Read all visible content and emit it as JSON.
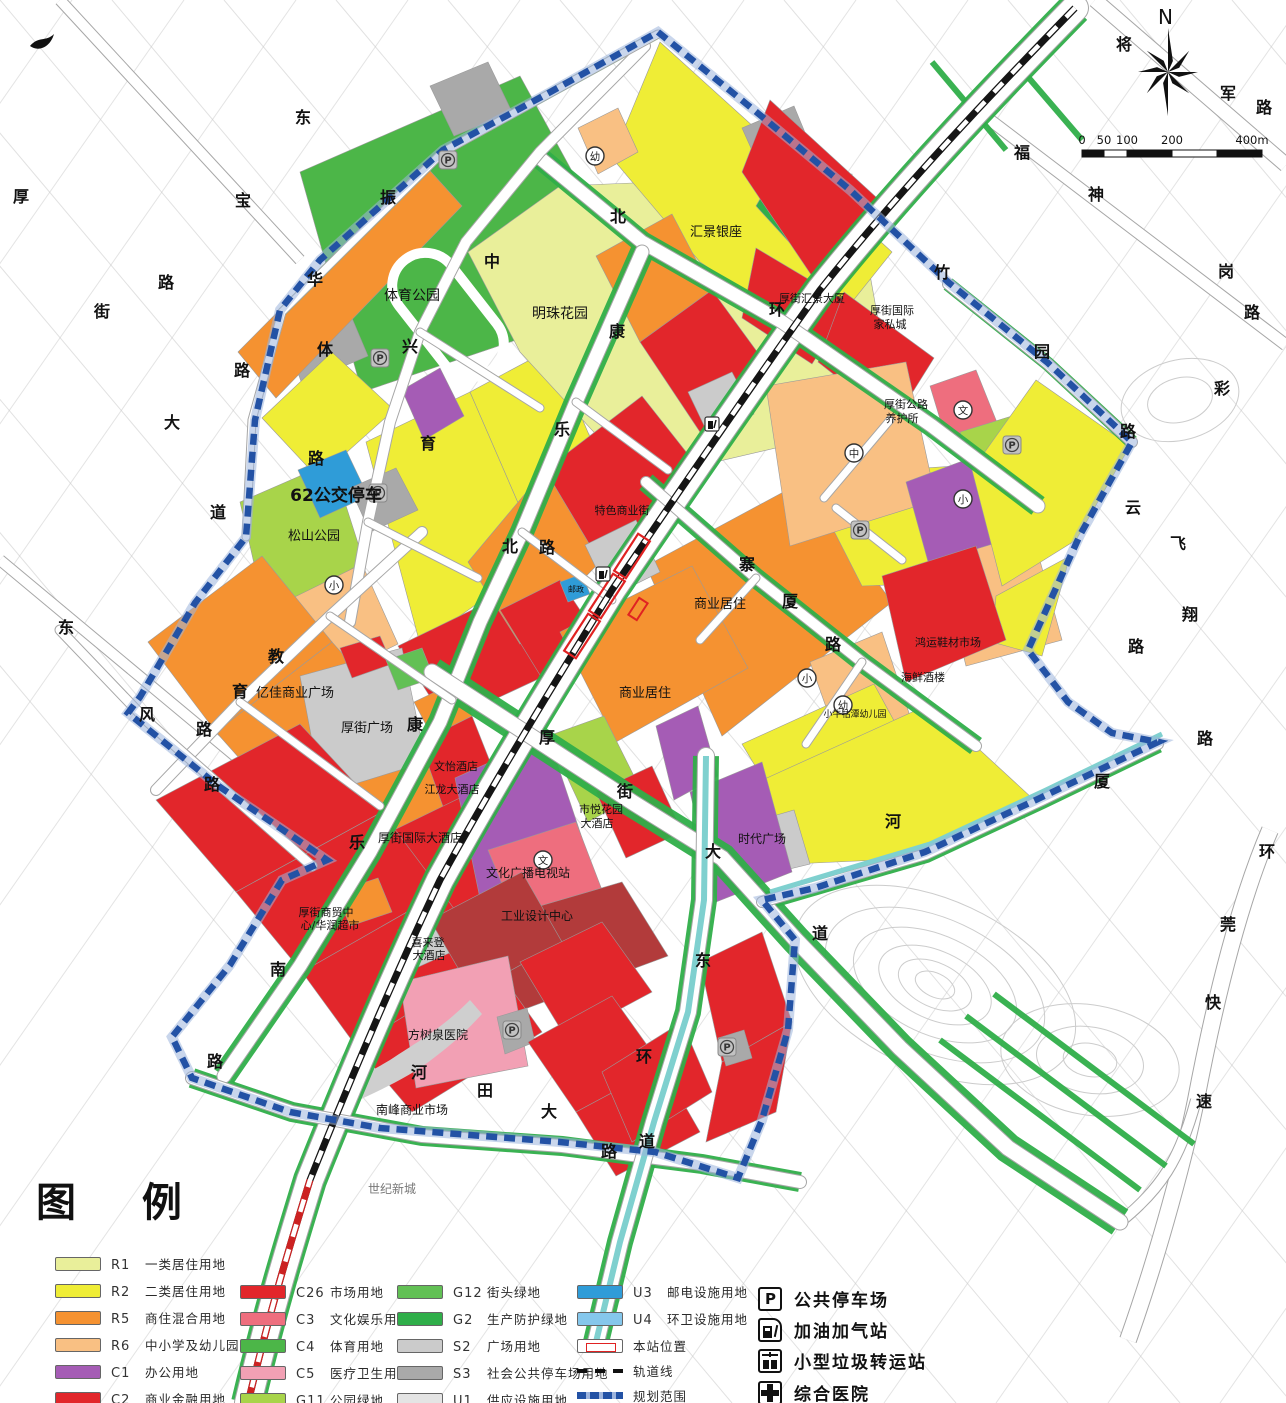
{
  "legend": {
    "title": "图 例",
    "land_use": [
      {
        "code": "R1",
        "label": "一类居住用地",
        "color": "#e9ef9a",
        "col": 1
      },
      {
        "code": "R2",
        "label": "二类居住用地",
        "color": "#efed36",
        "col": 1
      },
      {
        "code": "R5",
        "label": "商住混合用地",
        "color": "#f59231",
        "col": 1
      },
      {
        "code": "R6",
        "label": "中小学及幼儿园用地",
        "color": "#f9c083",
        "col": 1
      },
      {
        "code": "C1",
        "label": "办公用地",
        "color": "#a55cb5",
        "col": 1
      },
      {
        "code": "C2",
        "label": "商业金融用地",
        "color": "#e2262b",
        "col": 1
      },
      {
        "code": "C26",
        "label": "市场用地",
        "color": "#e2262b",
        "col": 2
      },
      {
        "code": "C3",
        "label": "文化娱乐用地",
        "color": "#ee6e7e",
        "col": 2
      },
      {
        "code": "C4",
        "label": "体育用地",
        "color": "#4cb648",
        "col": 2
      },
      {
        "code": "C5",
        "label": "医疗卫生用地",
        "color": "#f2a0b4",
        "col": 2
      },
      {
        "code": "G11",
        "label": "公园绿地",
        "color": "#a8d44a",
        "col": 2
      },
      {
        "code": "G12",
        "label": "街头绿地",
        "color": "#62c055",
        "col": 3
      },
      {
        "code": "G2",
        "label": "生产防护绿地",
        "color": "#2fae49",
        "col": 3
      },
      {
        "code": "S2",
        "label": "广场用地",
        "color": "#cbcbcb",
        "col": 3
      },
      {
        "code": "S3",
        "label": "社会公共停车场用地",
        "color": "#a9a9a9",
        "col": 3
      },
      {
        "code": "U1",
        "label": "供应设施用地",
        "color": "#e4e4e4",
        "col": 3
      },
      {
        "code": "U3",
        "label": "邮电设施用地",
        "color": "#2f9cd8",
        "col": 4
      },
      {
        "code": "U4",
        "label": "环卫设施用地",
        "color": "#85c7ec",
        "col": 4
      }
    ],
    "line_items": [
      {
        "kind": "station",
        "label": "本站位置"
      },
      {
        "kind": "rail",
        "label": "轨道线"
      },
      {
        "kind": "boundary",
        "label": "规划范围"
      }
    ],
    "symbol_items": [
      {
        "kind": "parking",
        "label": "公共停车场"
      },
      {
        "kind": "gas",
        "label": "加油加气站"
      },
      {
        "kind": "waste",
        "label": "小型垃圾转运站"
      },
      {
        "kind": "hospital",
        "label": "综合医院"
      }
    ]
  },
  "compass": {
    "label": "N"
  },
  "scalebar": {
    "ticks": [
      "0",
      "50",
      "100",
      "200",
      "400m"
    ]
  },
  "colors": {
    "boundary": "#2352a5",
    "boundary_halo": "#9db4dd",
    "rail": "#151515",
    "rail_red": "#cc2222",
    "station": "#e02222",
    "canal": "#7fd0cf",
    "road_casing": "#a6a6a6",
    "faint_street": "#c9c9c9",
    "contour": "#cccccc",
    "dark_red": "#b23b3b",
    "label": "#111111"
  },
  "map": {
    "road_chars": [
      {
        "c": "振",
        "x": 388,
        "y": 203
      },
      {
        "c": "华",
        "x": 315,
        "y": 285
      },
      {
        "c": "体",
        "x": 325,
        "y": 355
      },
      {
        "c": "兴",
        "x": 410,
        "y": 352
      },
      {
        "c": "中",
        "x": 492,
        "y": 267
      },
      {
        "c": "北",
        "x": 618,
        "y": 222
      },
      {
        "c": "环",
        "x": 777,
        "y": 315
      },
      {
        "c": "康",
        "x": 617,
        "y": 337
      },
      {
        "c": "乐",
        "x": 562,
        "y": 435
      },
      {
        "c": "北",
        "x": 510,
        "y": 552
      },
      {
        "c": "路",
        "x": 547,
        "y": 553
      },
      {
        "c": "育",
        "x": 428,
        "y": 449
      },
      {
        "c": "路",
        "x": 316,
        "y": 464
      },
      {
        "c": "教",
        "x": 276,
        "y": 662
      },
      {
        "c": "育",
        "x": 240,
        "y": 697
      },
      {
        "c": "路",
        "x": 204,
        "y": 735
      },
      {
        "c": "东",
        "x": 66,
        "y": 633
      },
      {
        "c": "风",
        "x": 147,
        "y": 720
      },
      {
        "c": "路",
        "x": 212,
        "y": 790
      },
      {
        "c": "康",
        "x": 415,
        "y": 730
      },
      {
        "c": "乐",
        "x": 357,
        "y": 848
      },
      {
        "c": "南",
        "x": 278,
        "y": 975
      },
      {
        "c": "路",
        "x": 215,
        "y": 1067
      },
      {
        "c": "寨",
        "x": 747,
        "y": 570
      },
      {
        "c": "厦",
        "x": 790,
        "y": 607
      },
      {
        "c": "路",
        "x": 833,
        "y": 650
      },
      {
        "c": "厚",
        "x": 547,
        "y": 743
      },
      {
        "c": "街",
        "x": 625,
        "y": 797
      },
      {
        "c": "大",
        "x": 713,
        "y": 857
      },
      {
        "c": "道",
        "x": 820,
        "y": 939
      },
      {
        "c": "河",
        "x": 419,
        "y": 1078
      },
      {
        "c": "田",
        "x": 485,
        "y": 1096
      },
      {
        "c": "大",
        "x": 549,
        "y": 1117
      },
      {
        "c": "道",
        "x": 647,
        "y": 1147
      },
      {
        "c": "东",
        "x": 703,
        "y": 966
      },
      {
        "c": "环",
        "x": 644,
        "y": 1062
      },
      {
        "c": "路",
        "x": 609,
        "y": 1157
      },
      {
        "c": "河",
        "x": 893,
        "y": 827
      },
      {
        "c": "竹",
        "x": 942,
        "y": 278
      },
      {
        "c": "园",
        "x": 1042,
        "y": 357
      },
      {
        "c": "路",
        "x": 1128,
        "y": 437
      },
      {
        "c": "将",
        "x": 1124,
        "y": 50
      },
      {
        "c": "军",
        "x": 1228,
        "y": 99
      },
      {
        "c": "路",
        "x": 1264,
        "y": 113
      },
      {
        "c": "东",
        "x": 303,
        "y": 123
      },
      {
        "c": "厚",
        "x": 21,
        "y": 202
      },
      {
        "c": "宝",
        "x": 243,
        "y": 206
      },
      {
        "c": "街",
        "x": 102,
        "y": 317
      },
      {
        "c": "路",
        "x": 166,
        "y": 288
      },
      {
        "c": "路",
        "x": 242,
        "y": 376
      },
      {
        "c": "大",
        "x": 172,
        "y": 428
      },
      {
        "c": "道",
        "x": 218,
        "y": 518
      },
      {
        "c": "环",
        "x": 1267,
        "y": 857
      },
      {
        "c": "莞",
        "x": 1228,
        "y": 930
      },
      {
        "c": "快",
        "x": 1213,
        "y": 1008
      },
      {
        "c": "速",
        "x": 1204,
        "y": 1107
      },
      {
        "c": "福",
        "x": 1022,
        "y": 158
      },
      {
        "c": "神",
        "x": 1096,
        "y": 200
      },
      {
        "c": "岗",
        "x": 1226,
        "y": 277
      },
      {
        "c": "路",
        "x": 1252,
        "y": 318
      },
      {
        "c": "彩",
        "x": 1222,
        "y": 394
      },
      {
        "c": "云",
        "x": 1133,
        "y": 513
      },
      {
        "c": "飞",
        "x": 1178,
        "y": 549
      },
      {
        "c": "翔",
        "x": 1190,
        "y": 620
      },
      {
        "c": "路",
        "x": 1136,
        "y": 652
      },
      {
        "c": "厦",
        "x": 1102,
        "y": 787
      },
      {
        "c": "路",
        "x": 1205,
        "y": 744
      }
    ],
    "places": [
      {
        "t": "体育公园",
        "x": 412,
        "y": 300,
        "s": 14
      },
      {
        "t": "明珠花园",
        "x": 560,
        "y": 318,
        "s": 14
      },
      {
        "t": "汇景银座",
        "x": 716,
        "y": 236,
        "s": 13
      },
      {
        "t": "厚街汇景大厦",
        "x": 812,
        "y": 302,
        "s": 11
      },
      {
        "t": "厚街国际",
        "x": 892,
        "y": 314,
        "s": 11
      },
      {
        "t": "家私城",
        "x": 890,
        "y": 328,
        "s": 11
      },
      {
        "t": "厚街公路",
        "x": 906,
        "y": 408,
        "s": 11
      },
      {
        "t": "养护所",
        "x": 902,
        "y": 422,
        "s": 11
      },
      {
        "t": "62公交停车",
        "x": 336,
        "y": 501,
        "s": 17,
        "b": true
      },
      {
        "t": "松山公园",
        "x": 314,
        "y": 540,
        "s": 13
      },
      {
        "t": "特色商业街",
        "x": 622,
        "y": 514,
        "s": 11
      },
      {
        "t": "商业居住",
        "x": 720,
        "y": 608,
        "s": 13
      },
      {
        "t": "商业居住",
        "x": 645,
        "y": 697,
        "s": 13
      },
      {
        "t": "鸿运鞋材市场",
        "x": 948,
        "y": 646,
        "s": 11
      },
      {
        "t": "海鲜酒楼",
        "x": 923,
        "y": 681,
        "s": 11
      },
      {
        "t": "小牛牯潭幼儿园",
        "x": 855,
        "y": 717,
        "s": 9
      },
      {
        "t": "亿佳商业广场",
        "x": 295,
        "y": 697,
        "s": 13
      },
      {
        "t": "厚街广场",
        "x": 367,
        "y": 732,
        "s": 13
      },
      {
        "t": "文怡酒店",
        "x": 456,
        "y": 770,
        "s": 11
      },
      {
        "t": "江龙大酒店",
        "x": 452,
        "y": 793,
        "s": 11
      },
      {
        "t": "厚街国际大酒店",
        "x": 420,
        "y": 842,
        "s": 12
      },
      {
        "t": "市悦花园",
        "x": 601,
        "y": 813,
        "s": 11
      },
      {
        "t": "大酒店",
        "x": 597,
        "y": 827,
        "s": 11
      },
      {
        "t": "文化广播电视站",
        "x": 528,
        "y": 877,
        "s": 12
      },
      {
        "t": "工业设计中心",
        "x": 537,
        "y": 920,
        "s": 12
      },
      {
        "t": "喜来登",
        "x": 428,
        "y": 946,
        "s": 11
      },
      {
        "t": "大酒店",
        "x": 429,
        "y": 959,
        "s": 11
      },
      {
        "t": "厚街商贸中",
        "x": 326,
        "y": 916,
        "s": 11
      },
      {
        "t": "心/华润超市",
        "x": 330,
        "y": 929,
        "s": 11
      },
      {
        "t": "方树泉医院",
        "x": 438,
        "y": 1039,
        "s": 12
      },
      {
        "t": "时代广场",
        "x": 762,
        "y": 843,
        "s": 12
      },
      {
        "t": "南峰商业市场",
        "x": 412,
        "y": 1114,
        "s": 12
      },
      {
        "t": "世纪新城",
        "x": 392,
        "y": 1193,
        "s": 12,
        "c": "#777777"
      },
      {
        "t": "邮政",
        "x": 576,
        "y": 592,
        "s": 8
      }
    ],
    "parking_marks": [
      {
        "x": 448,
        "y": 160
      },
      {
        "x": 380,
        "y": 358
      },
      {
        "x": 378,
        "y": 493
      },
      {
        "x": 860,
        "y": 530
      },
      {
        "x": 1012,
        "y": 445
      },
      {
        "x": 512,
        "y": 1030
      },
      {
        "x": 727,
        "y": 1047
      }
    ],
    "circle_marks": [
      {
        "ch": "文",
        "x": 963,
        "y": 410
      },
      {
        "ch": "文",
        "x": 543,
        "y": 860
      },
      {
        "ch": "中",
        "x": 854,
        "y": 453
      },
      {
        "ch": "小",
        "x": 334,
        "y": 585
      },
      {
        "ch": "小",
        "x": 807,
        "y": 678
      },
      {
        "ch": "小",
        "x": 963,
        "y": 499
      },
      {
        "ch": "幼",
        "x": 595,
        "y": 156
      },
      {
        "ch": "幼",
        "x": 843,
        "y": 705
      }
    ],
    "gas_marks": [
      {
        "x": 603,
        "y": 574
      },
      {
        "x": 712,
        "y": 424
      }
    ]
  }
}
